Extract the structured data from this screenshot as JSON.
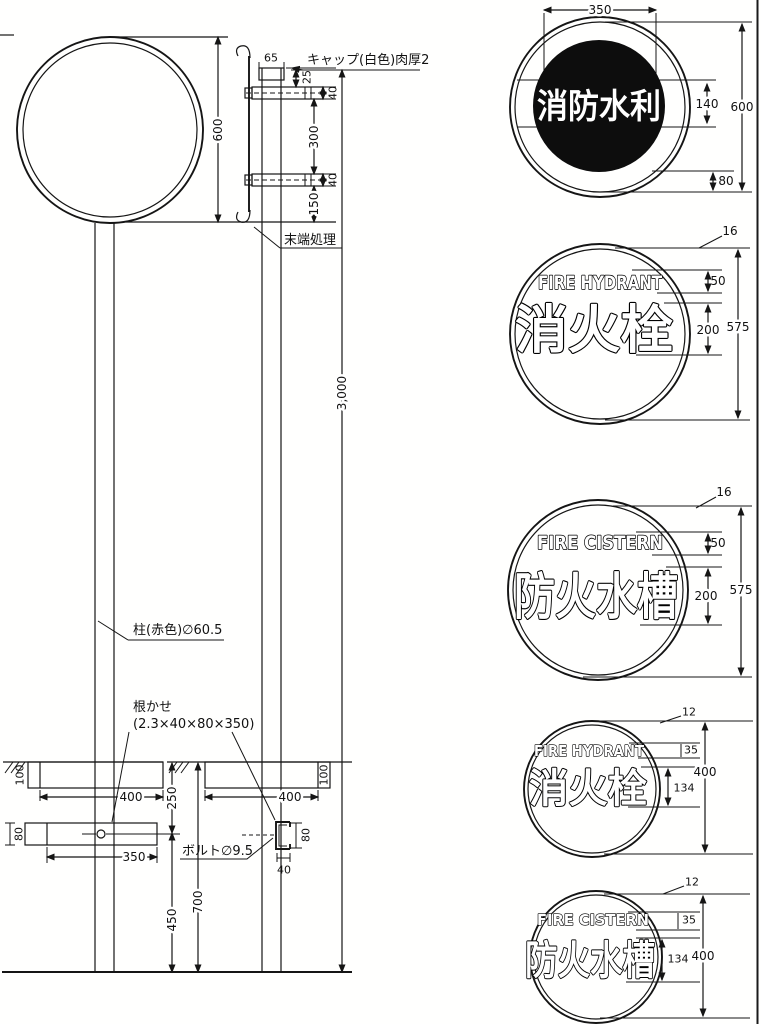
{
  "front_view": {
    "dim_diameter": "600",
    "dim_total_height": "3,000",
    "post_label": "柱(赤色)∅60.5",
    "anchor_label": "根かせ",
    "anchor_size": "(2.3×40×80×350)",
    "dim_embed_depth": "100",
    "dim_footing_width": "400",
    "dim_bar_height": "80",
    "dim_bar_width": "350",
    "dim_ground_offset": "250",
    "dim_bar_to_base": "450",
    "dim_embed_total": "700"
  },
  "side_view": {
    "cap_label": "キャップ(白色)肉厚2",
    "dim_cap_width": "65",
    "dim_cap_height": "25",
    "dim_bracket_upper": "40",
    "dim_bracket_gap": "300",
    "dim_bracket_lower": "40",
    "dim_plate_overhang": "150",
    "end_label": "末端処理",
    "bolt_label": "ボルト∅9.5",
    "dim_embed_depth": "100",
    "dim_footing_width": "400",
    "dim_channel_height": "80",
    "dim_channel_width": "40"
  },
  "signs": [
    {
      "jp": "消防水利",
      "dims": {
        "width": "350",
        "text_height": "140",
        "diameter": "600",
        "bottom_margin": "80"
      }
    },
    {
      "en": "FIRE HYDRANT",
      "jp": "消火栓",
      "dims": {
        "rim": "16",
        "en_height": "50",
        "jp_height": "200",
        "diameter": "575"
      }
    },
    {
      "en": "FIRE CISTERN",
      "jp": "防火水槽",
      "dims": {
        "rim": "16",
        "en_height": "50",
        "jp_height": "200",
        "diameter": "575"
      }
    },
    {
      "en": "FIRE HYDRANT",
      "jp": "消火栓",
      "dims": {
        "rim": "12",
        "en_height": "35",
        "jp_height": "134",
        "diameter": "400"
      }
    },
    {
      "en": "FIRE CISTERN",
      "jp": "防火水槽",
      "dims": {
        "rim": "12",
        "en_height": "35",
        "jp_height": "134",
        "diameter": "400"
      }
    }
  ]
}
